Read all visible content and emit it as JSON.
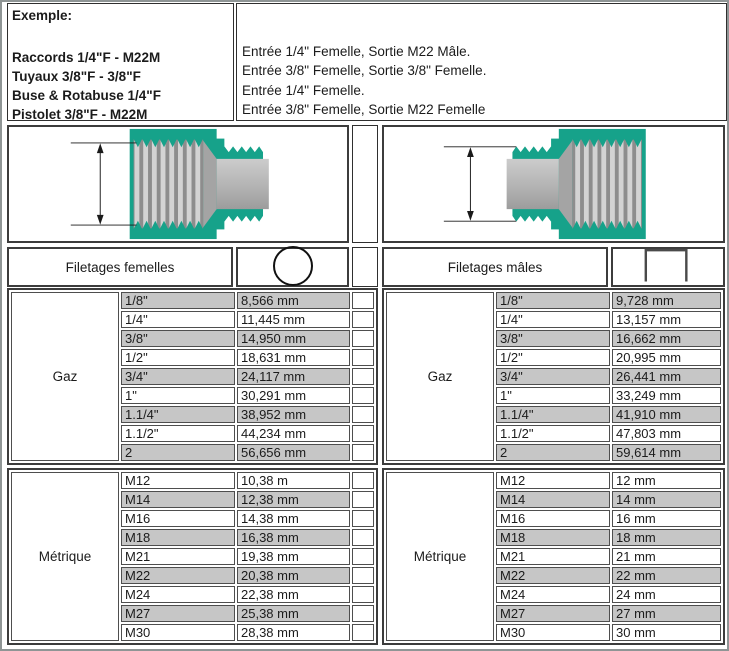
{
  "example": {
    "title": "Exemple:",
    "lines": [
      "Raccords 1/4\"F - M22M",
      "Tuyaux 3/8\"F - 3/8\"F",
      "Buse & Rotabuse 1/4\"F",
      "Pistolet 3/8\"F - M22M"
    ]
  },
  "description": {
    "lines": [
      "Entrée 1/4\" Femelle, Sortie M22 Mâle.",
      "Entrée 3/8\" Femelle, Sortie 3/8\" Femelle.",
      "Entrée 1/4\" Femelle.",
      "Entrée 3/8\" Femelle, Sortie M22 Femelle"
    ]
  },
  "headers": {
    "female_label": "Filetages femelles",
    "female_icon": "circle",
    "male_label": "Filetages mâles",
    "male_icon": "open-square"
  },
  "tables": {
    "female_gaz": {
      "label": "Gaz",
      "shade_start": 0,
      "rows": [
        [
          "1/8\"",
          "8,566 mm"
        ],
        [
          "1/4\"",
          "11,445 mm"
        ],
        [
          "3/8\"",
          "14,950 mm"
        ],
        [
          "1/2\"",
          "18,631 mm"
        ],
        [
          "3/4\"",
          "24,117 mm"
        ],
        [
          "1\"",
          "30,291 mm"
        ],
        [
          "1.1/4\"",
          "38,952 mm"
        ],
        [
          "1.1/2\"",
          "44,234 mm"
        ],
        [
          "2",
          "56,656 mm"
        ]
      ]
    },
    "female_metric": {
      "label": "Métrique",
      "shade_start": 1,
      "rows": [
        [
          "M12",
          "10,38 m"
        ],
        [
          "M14",
          "12,38 mm"
        ],
        [
          "M16",
          "14,38 mm"
        ],
        [
          "M18",
          "16,38 mm"
        ],
        [
          "M21",
          "19,38 mm"
        ],
        [
          "M22",
          "20,38 mm"
        ],
        [
          "M24",
          "22,38 mm"
        ],
        [
          "M27",
          "25,38 mm"
        ],
        [
          "M30",
          "28,38 mm"
        ]
      ]
    },
    "male_gaz": {
      "label": "Gaz",
      "shade_start": 0,
      "rows": [
        [
          "1/8\"",
          "9,728 mm"
        ],
        [
          "1/4\"",
          "13,157 mm"
        ],
        [
          "3/8\"",
          "16,662 mm"
        ],
        [
          "1/2\"",
          "20,995 mm"
        ],
        [
          "3/4\"",
          "26,441 mm"
        ],
        [
          "1\"",
          "33,249 mm"
        ],
        [
          "1.1/4\"",
          "41,910 mm"
        ],
        [
          "1.1/2\"",
          "47,803 mm"
        ],
        [
          "2",
          "59,614 mm"
        ]
      ]
    },
    "male_metric": {
      "label": "Métrique",
      "shade_start": 1,
      "rows": [
        [
          "M12",
          "12 mm"
        ],
        [
          "M14",
          "14 mm"
        ],
        [
          "M16",
          "16 mm"
        ],
        [
          "M18",
          "18 mm"
        ],
        [
          "M21",
          "21 mm"
        ],
        [
          "M22",
          "22 mm"
        ],
        [
          "M24",
          "24 mm"
        ],
        [
          "M27",
          "27 mm"
        ],
        [
          "M30",
          "30 mm"
        ]
      ]
    }
  },
  "colors": {
    "teal": "#16a28a",
    "row_shade": "#c6c6c6",
    "border_dark": "#3c3c3c",
    "frame": "#8f9595"
  }
}
